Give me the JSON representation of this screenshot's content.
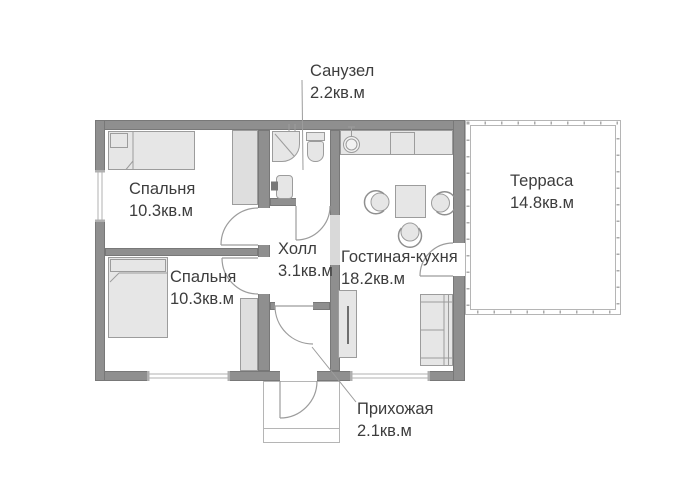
{
  "plan_type": "house floor plan",
  "rooms": {
    "bathroom": {
      "label": "Санузел",
      "area": "2.2кв.м"
    },
    "bedroom_top": {
      "label": "Спальня",
      "area": "10.3кв.м"
    },
    "bedroom_bottom": {
      "label": "Спальня",
      "area": "10.3кв.м"
    },
    "hall": {
      "label": "Холл",
      "area": "3.1кв.м"
    },
    "living_kitchen": {
      "label": "Гостиная-кухня",
      "area": "18.2кв.м"
    },
    "terrace": {
      "label": "Терраса",
      "area": "14.8кв.м"
    },
    "entry": {
      "label": "Прихожая",
      "area": "2.1кв.м"
    }
  },
  "fixtures": [
    "single-bed",
    "double-bed",
    "wardrobe",
    "wardrobe",
    "corner-shower",
    "toilet",
    "washbasin",
    "kitchen-counter",
    "kitchen-sink",
    "stove",
    "dining-table",
    "chair",
    "chair",
    "chair",
    "sofa",
    "tall-cabinet",
    "entrance-porch",
    "terrace-decking"
  ],
  "colors": {
    "wall": "#8f8f8f",
    "wall_edge": "#787878",
    "furniture_fill": "#e6e6e6",
    "line": "#9c9c9c",
    "terrace_border": "#b5b5b5",
    "text": "#3d3d3d",
    "background": "#ffffff"
  }
}
